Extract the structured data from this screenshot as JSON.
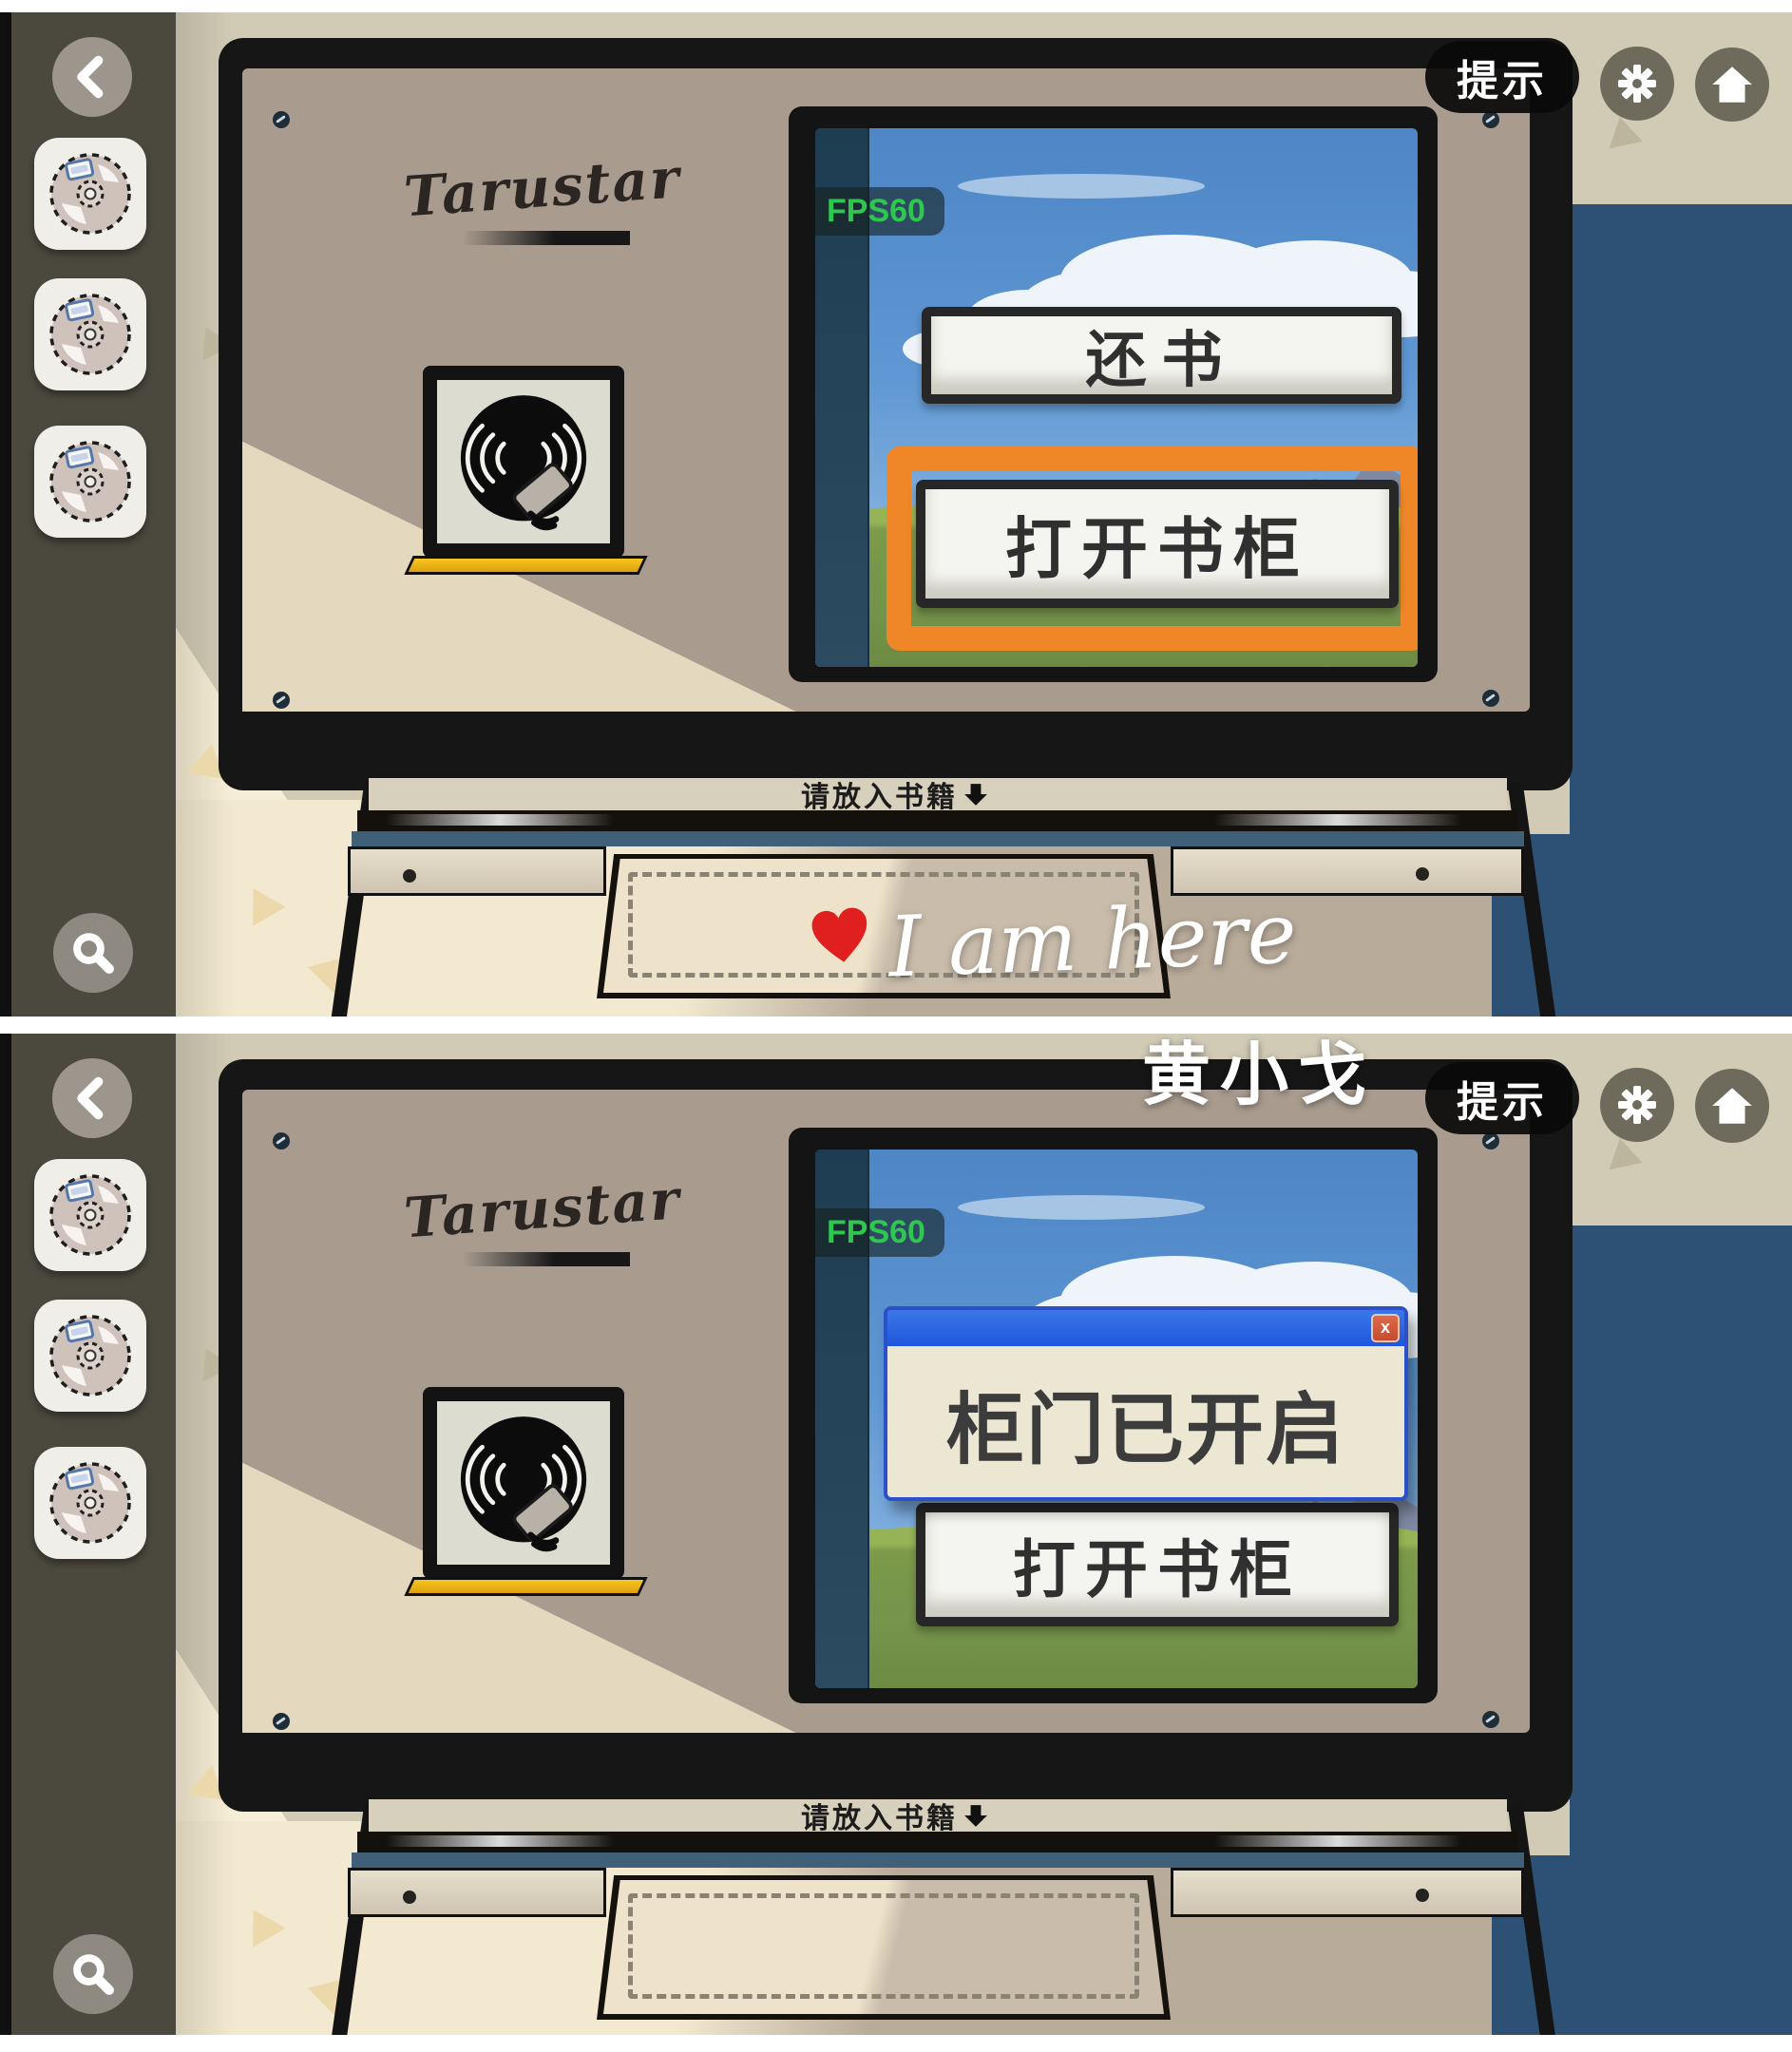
{
  "chrome": {
    "hint_label": "提示",
    "back_icon": "chevron-left",
    "settings_icon": "gear",
    "home_icon": "house",
    "search_icon": "magnifier"
  },
  "sidebar": {
    "disc_icon": "cd",
    "disc_count": 3
  },
  "machine": {
    "brand": "Tarustar",
    "slot_label": "请放入书籍",
    "slot_arrow_icon": "down-arrow",
    "reader_icon": "disc-reader"
  },
  "screen_a": {
    "fps": "FPS60",
    "button_return": "还书",
    "button_open": "打开书柜",
    "highlight_color": "#ef8728"
  },
  "screen_b": {
    "fps": "FPS60",
    "dialog_message": "柜门已开启",
    "dialog_close": "x",
    "button_open": "打开书柜"
  },
  "watermark": {
    "heart_icon": "heart",
    "script": "I am here",
    "signature": "黄小戈"
  },
  "colors": {
    "wall_blue": "#2d5174",
    "background_khaki": "#d1cbb6",
    "background_cream": "#f7eed7",
    "sidebar_olive": "#4b483d",
    "machine_tan": "#a99c8f",
    "orange_highlight": "#ef8728",
    "dialog_title_blue": "#1f56dd",
    "fps_green": "#2fc84f",
    "reader_bar_gold": "#f2b718"
  }
}
